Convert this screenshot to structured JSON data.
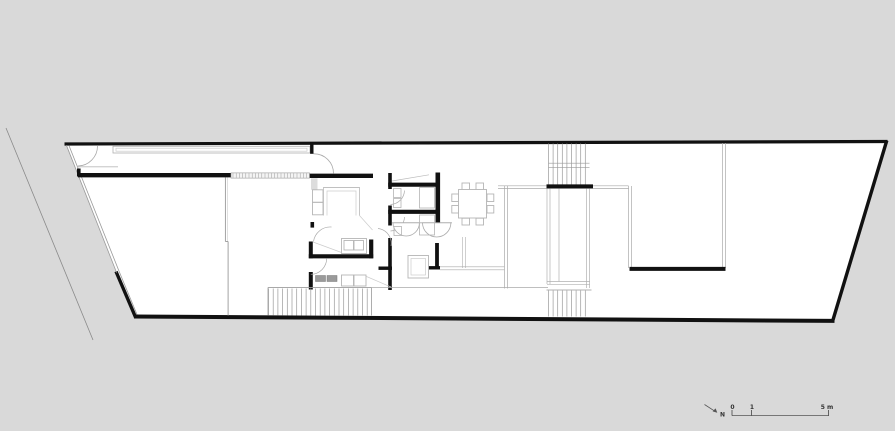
{
  "document": {
    "kind": "architectural-floor-plan",
    "colors": {
      "background": "#d9d9d9",
      "floor": "#ffffff",
      "wall": "#111111",
      "thin_line": "#a8a8a8",
      "furniture_line": "#b5b5b5",
      "appliance_fill": "#9a9a9a",
      "annotation": "#333333"
    }
  },
  "north": {
    "label": "N"
  },
  "scale_bar": {
    "zero": "0",
    "one": "1",
    "five": "5 m"
  }
}
